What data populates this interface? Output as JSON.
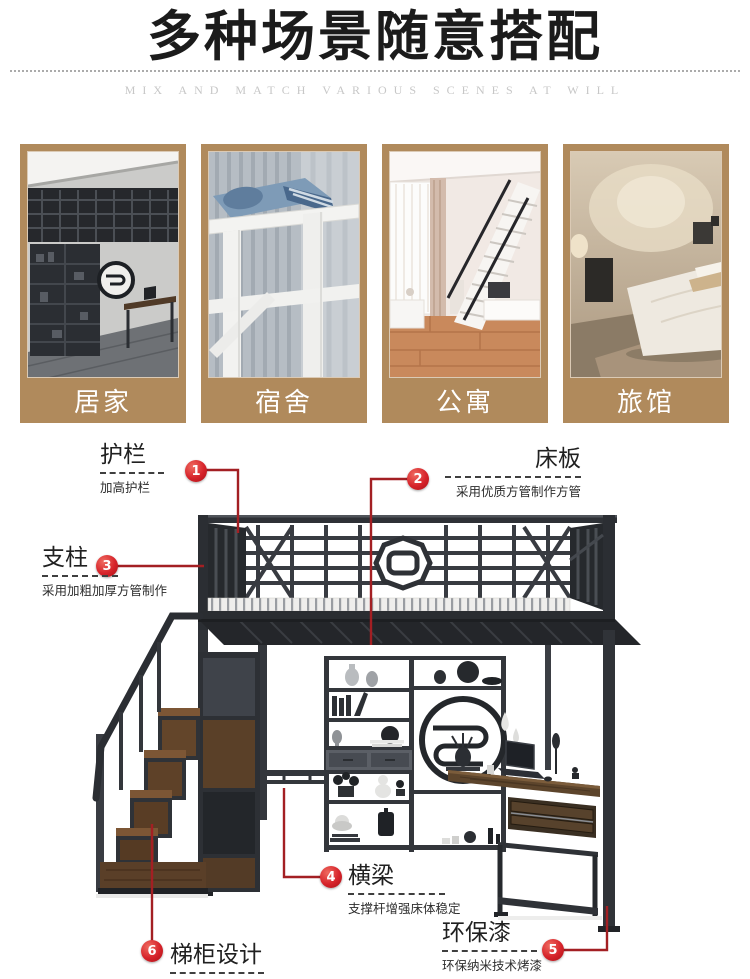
{
  "header": {
    "title": "多种场景随意搭配",
    "subtitle": "MIX AND MATCH VARIOUS SCENES AT WILL"
  },
  "scenes": {
    "card_bg": "#b08a5c",
    "items": [
      {
        "label": "居家"
      },
      {
        "label": "宿舍"
      },
      {
        "label": "公寓"
      },
      {
        "label": "旅馆"
      }
    ]
  },
  "diagram": {
    "badge_color": "#d6232a",
    "line_color": "#a31f23",
    "metal_color": "#33363b",
    "wood_color": "#6b4a2e",
    "callouts": [
      {
        "num": "1",
        "title": "护栏",
        "desc": "加高护栏"
      },
      {
        "num": "2",
        "title": "床板",
        "desc": "采用优质方管制作方管"
      },
      {
        "num": "3",
        "title": "支柱",
        "desc": "采用加粗加厚方管制作"
      },
      {
        "num": "4",
        "title": "横梁",
        "desc": "支撑杆增强床体稳定"
      },
      {
        "num": "5",
        "title": "环保漆",
        "desc": "环保纳米技术烤漆"
      },
      {
        "num": "6",
        "title": "梯柜设计",
        "desc": "梯柜设计，合理利用空间"
      }
    ]
  }
}
